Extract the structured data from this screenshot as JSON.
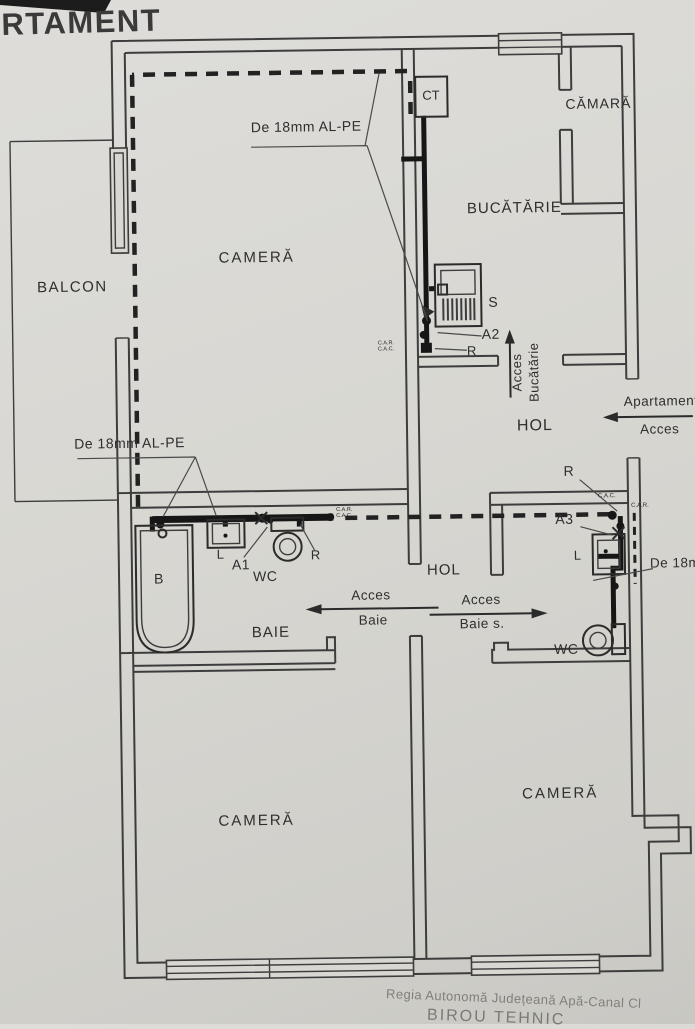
{
  "page": {
    "title_partial": "RTAMENT"
  },
  "rooms": {
    "balcon": "BALCON",
    "camera_top": "CAMERĂ",
    "bucatarie": "BUCĂTĂRIE",
    "camara": "CĂMARĂ",
    "hol_top": "HOL",
    "hol_mid": "HOL",
    "baie": "BAIE",
    "camera_bottom_left": "CAMERĂ",
    "camera_bottom_right": "CAMERĂ"
  },
  "fixtures": {
    "ct": "CT",
    "stove": "S",
    "bathtub": "B",
    "sink_left": "L",
    "wc_left": "WC",
    "sink_right": "L",
    "wc_right": "WC"
  },
  "annotations": {
    "pipe_top": "De 18mm AL-PE",
    "pipe_mid": "De 18mm AL-PE",
    "pipe_right": "De 18mm AL-PE",
    "a1": "A1",
    "a2": "A2",
    "a3": "A3",
    "r_kitchen": "R",
    "r_bath": "R",
    "r_right": "R",
    "car": "C.A.R.",
    "cac": "C.A.C."
  },
  "access": {
    "bucatarie_line1": "Acces",
    "bucatarie_line2": "Bucătărie",
    "apartament_line1": "Apartament",
    "apartament_line2": "Acces",
    "baie_line1": "Acces",
    "baie_line2": "Baie",
    "baie_s_line1": "Acces",
    "baie_s_line2": "Baie s."
  },
  "footer": {
    "line1": "Regia Autonomă Județeană Apă-Canal Cl",
    "line2": "BIROU TEHNIC"
  },
  "colors": {
    "paper": "#d8d7d2",
    "ink": "#3d3d3d",
    "pipe": "#161616"
  }
}
